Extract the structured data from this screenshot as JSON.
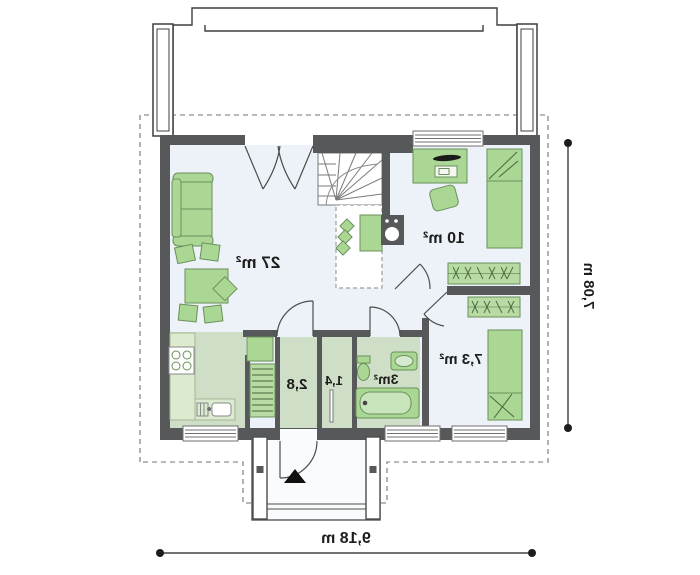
{
  "plan": {
    "type": "floor-plan",
    "mirrored": true,
    "rooms": {
      "living": {
        "area_label": "27 m²"
      },
      "bedroom_large": {
        "area_label": "10 m²"
      },
      "bedroom_small": {
        "area_label": "7,3 m²"
      },
      "bathroom": {
        "area_label": "3m²"
      },
      "hall": {
        "area_label": "2,8"
      },
      "corridor": {
        "area_label": "1,4"
      }
    },
    "dimensions": {
      "overall_width": "9,18 m",
      "overall_depth": "7,08 m"
    },
    "colors": {
      "wall": "#57585a",
      "room_floor": "#edf1f8",
      "service_floor": "#cfdec6",
      "counter": "#dceacf",
      "furniture_fill": "#abd795",
      "furniture_stroke": "#69905a",
      "hatch_stroke": "#47663b",
      "dashed_boundary": "#a0a0a0",
      "door_arc": "#4c4c4c",
      "label_text": "#1d1d1d"
    },
    "icons": [
      "entrance-arrow-icon",
      "stove-icon",
      "dimension-dots"
    ]
  }
}
